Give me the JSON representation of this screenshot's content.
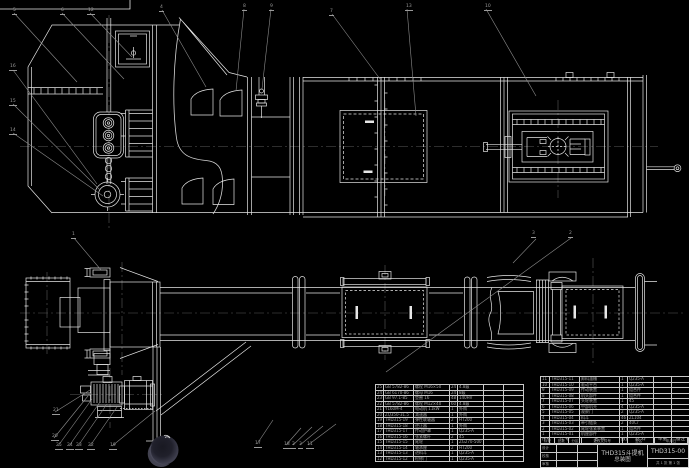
{
  "page": {
    "background": "#000000",
    "geometry_color": "#e6e6e6",
    "leader_color": "#8c8c8c",
    "centerline_color": "#5a5a5a"
  },
  "title_block": {
    "product_title": "THD315斗提机",
    "drawing_title": "总装图",
    "drawing_number": "THD315-00",
    "sheet_info": "共 1 张 第 1 张",
    "revision_headers": [
      "标记",
      "处数",
      "分区",
      "更改文件号",
      "签名",
      "年月日"
    ],
    "approval_rows": [
      [
        "设计",
        "",
        ""
      ],
      [
        "校核",
        "",
        ""
      ],
      [
        "审核",
        "",
        ""
      ]
    ]
  },
  "bom_right": {
    "header": [
      "序号",
      "代 号",
      "名 称",
      "数量",
      "材 料",
      "单重",
      "备注"
    ],
    "col_widths": [
      9,
      30,
      40,
      8,
      26,
      18,
      18
    ],
    "rows": [
      [
        "11",
        "THD315-11",
        "卸料溜槽",
        "1",
        "Q235-A",
        "",
        ""
      ],
      [
        "10",
        "THD315-10",
        "驱动平台",
        "1",
        "Q235-A",
        "",
        ""
      ],
      [
        "9",
        "THD315-09",
        "传动装置",
        "1",
        "组合件",
        "",
        ""
      ],
      [
        "8",
        "THD315-08",
        "机头部件",
        "1",
        "组合件",
        "",
        ""
      ],
      [
        "7",
        "THD315-07",
        "头轮装置",
        "1",
        "45",
        "",
        ""
      ],
      [
        "6",
        "THD315-06",
        "中部机壳",
        "4",
        "Q235-A",
        "",
        ""
      ],
      [
        "5",
        "THD315-05",
        "观察门",
        "2",
        "Q235-A",
        "",
        ""
      ],
      [
        "4",
        "THD315-04",
        "料斗",
        "46",
        "ZL104",
        "",
        ""
      ],
      [
        "3",
        "THD315-03",
        "牵引链条",
        "2",
        "40Cr",
        "",
        ""
      ],
      [
        "2",
        "THD315-02",
        "尾轮张紧装置",
        "1",
        "组合件",
        "",
        ""
      ],
      [
        "1",
        "THD315-01",
        "机座部件",
        "1",
        "Q235-A",
        "",
        ""
      ]
    ]
  },
  "bom_left": {
    "col_widths": [
      8,
      30,
      36,
      8,
      26,
      20,
      20
    ],
    "rows": [
      [
        "25",
        "GB 5782-86",
        "螺栓 M16×50",
        "24",
        "4.8级",
        "",
        ""
      ],
      [
        "24",
        "GB 6170-86",
        "螺母 M16",
        "24",
        "8级",
        "",
        ""
      ],
      [
        "23",
        "GB 97.1-85",
        "垫圈 16",
        "48",
        "140HV",
        "",
        ""
      ],
      [
        "22",
        "GB 5782-86",
        "螺栓 M12×40",
        "60",
        "4.8级",
        "",
        ""
      ],
      [
        "21",
        "Y160M-4",
        "电动机 11kW",
        "1",
        "外购",
        "",
        ""
      ],
      [
        "20",
        "ZQ350-31.5",
        "减速器",
        "1",
        "外购",
        "",
        ""
      ],
      [
        "19",
        "THD315-19",
        "弹性联轴器",
        "2",
        "HT200",
        "",
        ""
      ],
      [
        "18",
        "THD315-18",
        "逆止器",
        "1",
        "外购",
        "",
        ""
      ],
      [
        "17",
        "THD315-17",
        "传动护罩",
        "1",
        "Q235-A",
        "",
        ""
      ],
      [
        "16",
        "THD315-16",
        "张紧螺杆",
        "2",
        "45",
        "",
        ""
      ],
      [
        "15",
        "THD315-15",
        "尾轮",
        "1",
        "ZG270-500",
        "",
        ""
      ],
      [
        "14",
        "THD315-14",
        "轴承座",
        "2",
        "HT200",
        "",
        ""
      ],
      [
        "13",
        "THD315-13",
        "进料斗",
        "1",
        "Q235-A",
        "",
        ""
      ],
      [
        "12",
        "THD315-12",
        "检修门",
        "1",
        "Q235-A",
        "",
        ""
      ]
    ]
  },
  "balloons": [
    {
      "n": "5",
      "x": 12,
      "y": 9
    },
    {
      "n": "6",
      "x": 60,
      "y": 9
    },
    {
      "n": "12",
      "x": 87,
      "y": 9
    },
    {
      "n": "4",
      "x": 159,
      "y": 6
    },
    {
      "n": "8",
      "x": 242,
      "y": 5
    },
    {
      "n": "9",
      "x": 269,
      "y": 5
    },
    {
      "n": "7",
      "x": 329,
      "y": 10
    },
    {
      "n": "13",
      "x": 405,
      "y": 5
    },
    {
      "n": "10",
      "x": 484,
      "y": 5
    },
    {
      "n": "16",
      "x": 9,
      "y": 65
    },
    {
      "n": "15",
      "x": 9,
      "y": 100
    },
    {
      "n": "14",
      "x": 9,
      "y": 129
    },
    {
      "n": "1",
      "x": 71,
      "y": 233
    },
    {
      "n": "3",
      "x": 531,
      "y": 232
    },
    {
      "n": "2",
      "x": 568,
      "y": 232
    },
    {
      "n": "21",
      "x": 52,
      "y": 409
    },
    {
      "n": "20",
      "x": 51,
      "y": 435
    },
    {
      "n": "25",
      "x": 55,
      "y": 444
    },
    {
      "n": "24",
      "x": 66,
      "y": 444
    },
    {
      "n": "23",
      "x": 75,
      "y": 444
    },
    {
      "n": "22",
      "x": 87,
      "y": 444
    },
    {
      "n": "19",
      "x": 109,
      "y": 444
    },
    {
      "n": "17",
      "x": 254,
      "y": 442
    },
    {
      "n": "18",
      "x": 283,
      "y": 443
    },
    {
      "n": "2",
      "x": 291,
      "y": 443
    },
    {
      "n": "3",
      "x": 298,
      "y": 443
    },
    {
      "n": "11",
      "x": 306,
      "y": 443
    }
  ]
}
